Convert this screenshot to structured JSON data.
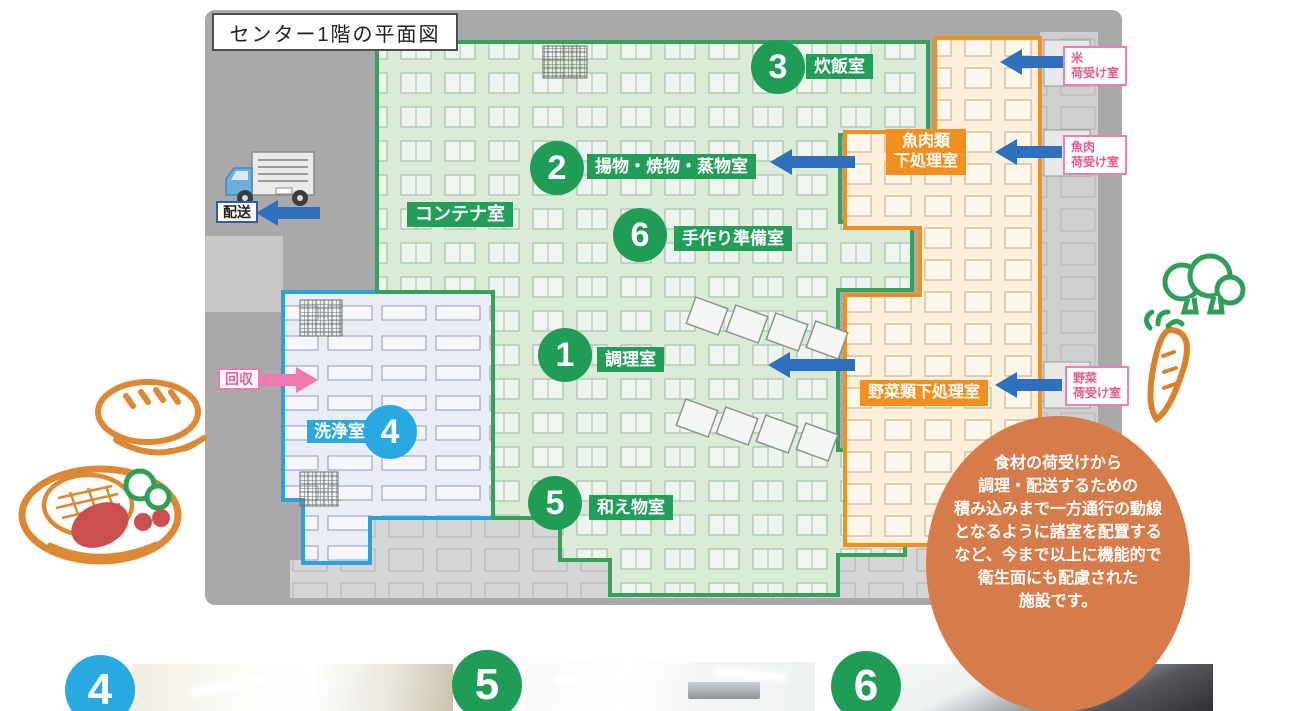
{
  "title": "センター1階の平面図",
  "zones": {
    "green_rooms": [
      {
        "num": "1",
        "label": "調理室"
      },
      {
        "num": "2",
        "label": "揚物・焼物・蒸物室"
      },
      {
        "num": "3",
        "label": "炊飯室"
      },
      {
        "num": "5",
        "label": "和え物室"
      },
      {
        "num": "6",
        "label": "手作り準備室"
      }
    ],
    "container_room": "コンテナ室",
    "wash_room": {
      "num": "4",
      "label": "洗浄室"
    },
    "orange_rooms": [
      {
        "line1": "魚肉類",
        "line2": "下処理室"
      },
      {
        "label": "野菜類下処理室"
      }
    ]
  },
  "receiving": [
    {
      "line1": "米",
      "line2": "荷受け室"
    },
    {
      "line1": "魚肉",
      "line2": "荷受け室"
    },
    {
      "line1": "野菜",
      "line2": "荷受け室"
    }
  ],
  "flow": {
    "delivery": "配送",
    "collection": "回収"
  },
  "callout": {
    "lines": [
      "食材の荷受けから",
      "調理・配送するための",
      "積み込みまで一方通行の動線",
      "となるように諸室を配置する",
      "など、今まで以上に機能的で",
      "衛生面にも配慮された",
      "施設です。"
    ]
  },
  "photos": [
    {
      "num": "4"
    },
    {
      "num": "5"
    },
    {
      "num": "6"
    }
  ],
  "colors": {
    "room_green": "#1f9d57",
    "zone_green_border": "#35a15d",
    "zone_orange": "#f38f1d",
    "zone_blue": "#29a9e1",
    "arrow_blue": "#2e6fbe",
    "pink": "#ee7fb2",
    "callout_orange": "#d57c4a",
    "panel_gray": "#a9a9a9"
  }
}
